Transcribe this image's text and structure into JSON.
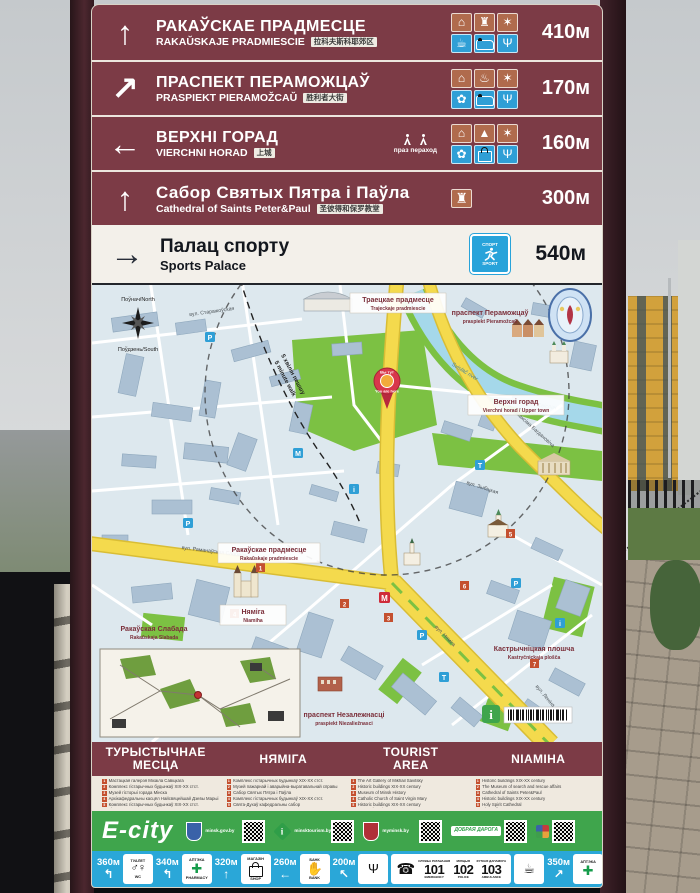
{
  "colors": {
    "maroon": "#7c3b46",
    "sign_cream": "#f2efe9",
    "map_base": "#dde8ee",
    "road_yellow": "#f4da4d",
    "park_green": "#7cc143",
    "river_blue": "#a5d8ea",
    "ecity_green": "#3fa54c",
    "strip_blue": "#2aa7d8",
    "warm_tile": "#b06b4d",
    "cool_tile": "#2f9fd6"
  },
  "icon_map": {
    "up": "↑",
    "up-right": "↗",
    "left": "←",
    "right": "→",
    "up-left": "↖",
    "left-curve": "↰",
    "museum": "⌂",
    "castle": "♜",
    "church": "♜",
    "monument": "▲",
    "entertainment": "✶",
    "fountain": "♨",
    "cafe": "☕",
    "restaurant": "Ψ",
    "souvenir": "✿",
    "bank": "✋",
    "toilet": "♂♀",
    "pharmacy": "✚",
    "phone": "☎"
  },
  "sign": {
    "directions": [
      {
        "arrow": "up",
        "title": "РАКАЎСКАЕ ПРАДМЕСЦЕ",
        "latin": "RAKAŬSKAJE PRADMIESCIE",
        "chinese": "拉科夫斯科耶郊区",
        "distance": "410м",
        "icons": [
          "museum",
          "castle",
          "entertainment",
          "cafe",
          "hotel",
          "restaurant"
        ]
      },
      {
        "arrow": "up-right",
        "title": "ПРАСПЕКТ ПЕРАМОЖЦАЎ",
        "latin": "PRASPIEKT PIERAMOŽCAŬ",
        "chinese": "胜利者大街",
        "distance": "170м",
        "icons": [
          "museum",
          "fountain",
          "entertainment",
          "souvenir",
          "hotel",
          "restaurant"
        ]
      },
      {
        "arrow": "left",
        "title": "ВЕРХНІ ГОРАД",
        "latin": "VIERCHNI HORAD",
        "chinese": "上城",
        "crossing_note": "праз пераход",
        "distance": "160м",
        "icons": [
          "museum",
          "monument",
          "entertainment",
          "souvenir",
          "shop",
          "restaurant"
        ]
      },
      {
        "arrow": "up",
        "title": "Сабор Святых Пятра і Паўла",
        "latin": "Cathedral of Saints Peter&Paul",
        "chinese": "圣彼得和保罗教堂",
        "distance": "300м",
        "icons": [
          "church"
        ]
      }
    ],
    "sports_row": {
      "arrow": "right",
      "title": "Палац спорту",
      "latin": "Sports Palace",
      "distance": "540м",
      "icon_top": "СПОРТ",
      "icon_bottom": "SPORT"
    },
    "map": {
      "compass": {
        "north": "Поўнач/North",
        "south": "Поўдзень/South"
      },
      "walk_note": {
        "be": "5 хвілін пешшу",
        "en": "5 minute walk"
      },
      "pin": {
        "be": "Вы тут",
        "en": "You are here"
      },
      "areas": {
        "trajeckaje": {
          "be": "Траецкае прадмесце",
          "lat": "Trajeckaje pradmiescie"
        },
        "pieramozcau": {
          "be": "праспект Пераможцаў",
          "lat": "praspiekt Pieramožcaŭ"
        },
        "rakauskaje": {
          "be": "Ракаўскае прадмесце",
          "lat": "Rakaŭskaje pradmiescie"
        },
        "vierchni": {
          "be": "Верхні горад",
          "lat": "Vierchni horad / Upper town"
        },
        "niamiha": {
          "be": "Няміга",
          "lat": "Niamiha"
        },
        "slabada": {
          "be": "Ракаўская Слабада",
          "lat": "Rakaŭskaja Slabada"
        },
        "kastrycnickaja": {
          "be": "Кастрычніцкая плошча",
          "lat": "Kastryčnickaja plošča"
        },
        "niezaleznasci": {
          "be": "праспект Незалежнасці",
          "lat": "praspiekt Niezaliežnasci"
        }
      },
      "river": {
        "be": "рака Свіслач",
        "en": "Svislač river"
      },
      "streets": [
        "вул. Няміга",
        "вул. Максіма Багдановіча",
        "вул. Раманаўская Слабада",
        "вул. Леніна",
        "вул. Старажоўская",
        "вул. Зыбіцкая"
      ]
    },
    "legend": {
      "columns": [
        {
          "header": "ТУРЫСТЫЧНАЕ\nМЕСЦА",
          "items": [
            "Мастацкая галерэя Міхаіла Савіцкага",
            "Комплекс гістарычных будынкаў XIX-XX стст.",
            "Музей гісторыі горада Мінска",
            "Архікафедральны касцёл Найсвяцейшай Дзевы Марыі",
            "Комплекс гістарычных будынкаў XIX-XX стст.",
            "Кінатэатр «Перамога»",
            "Комплекс гістарычных будынкаў XIX-XX стст."
          ]
        },
        {
          "header": "НЯМІГА",
          "items": [
            "Комплекс гістарычных будынкаў XIX-XX стст.",
            "Музей пажарнай і аварыйна-выратавальнай справы",
            "Сабор Святых Пятра і Паўла",
            "Комплекс гістарычных будынкаў XIX-XX стст.",
            "Свята-Духаў кафедральны сабор",
            "Гарадская ратуша",
            "Беларуская дзяржаўная акадэмія музыкі"
          ]
        },
        {
          "header": "TOURIST\nAREA",
          "items": [
            "The Art Gallery of Mikhail Savitsky",
            "Historic buildings XIX-XX century",
            "Museum of Minsk History",
            "Catholic Church of Saint Virgin Mary",
            "Historic buildings XIX-XX century",
            "Peramoha Cinema",
            "Historic buildings XIX-XX century"
          ]
        },
        {
          "header": "NIAMIHA",
          "items": [
            "Historic buildings XIX-XX century",
            "The Museum of search and rescue affairs",
            "Cathedral of Saints Peter&Paul",
            "Historic buildings XIX-XX century",
            "Holy Spirit Cathedral",
            "City Hall",
            "Belarusian State Academy of Music"
          ]
        }
      ]
    },
    "footer": {
      "brand": "E-city",
      "partners": [
        {
          "caption": "minsk.gov.by",
          "logo": "minsk-coat-of-arms"
        },
        {
          "caption": "minsktourism.by",
          "logo": "info-sign"
        },
        {
          "caption": "myminsk.by",
          "logo": "city-emblem"
        },
        {
          "caption": "ДОБРАЯ ДАРОГА",
          "logo": "good-road"
        },
        {
          "caption": "",
          "logo": "belarus-emblem"
        }
      ],
      "services_left": [
        {
          "distance": "360м",
          "arrow": "left-curve",
          "icon": "toilet",
          "top": "ТУАЛЕТ",
          "bottom": "WC"
        },
        {
          "distance": "340м",
          "arrow": "left-curve",
          "icon": "pharmacy",
          "top": "АПТЭКА",
          "bottom": "PHARMACY"
        },
        {
          "distance": "320м",
          "arrow": "up",
          "icon": "shop",
          "top": "МАГАЗІН",
          "bottom": "SHOP"
        },
        {
          "distance": "260м",
          "arrow": "left",
          "icon": "bank",
          "top": "БАНК",
          "bottom": "BANK"
        },
        {
          "distance": "200м",
          "arrow": "up-left",
          "icon": "restaurant"
        }
      ],
      "emergency": {
        "be": [
          "СЛУЖБА РАТАВАННЯ",
          "МІЛІЦЫЯ",
          "ХУТКАЯ ДАПАМОГА"
        ],
        "numbers": [
          "101",
          "102",
          "103"
        ],
        "en": [
          "EMERGENCY",
          "POLICE",
          "AMBULANCE"
        ]
      },
      "services_right": [
        {
          "icon": "cafe",
          "distance": "350м",
          "arrow": "up-right"
        },
        {
          "icon": "pharmacy",
          "top": "АПТЭКА",
          "distance": "360м",
          "arrow": "up-right"
        },
        {
          "icon": "restaurant",
          "distance": "400м",
          "arrow": "up-right"
        },
        {
          "icon": "hotel",
          "top": "ГАТЭЛЬ",
          "distance": "450м",
          "arrow": "up-right"
        }
      ]
    }
  }
}
